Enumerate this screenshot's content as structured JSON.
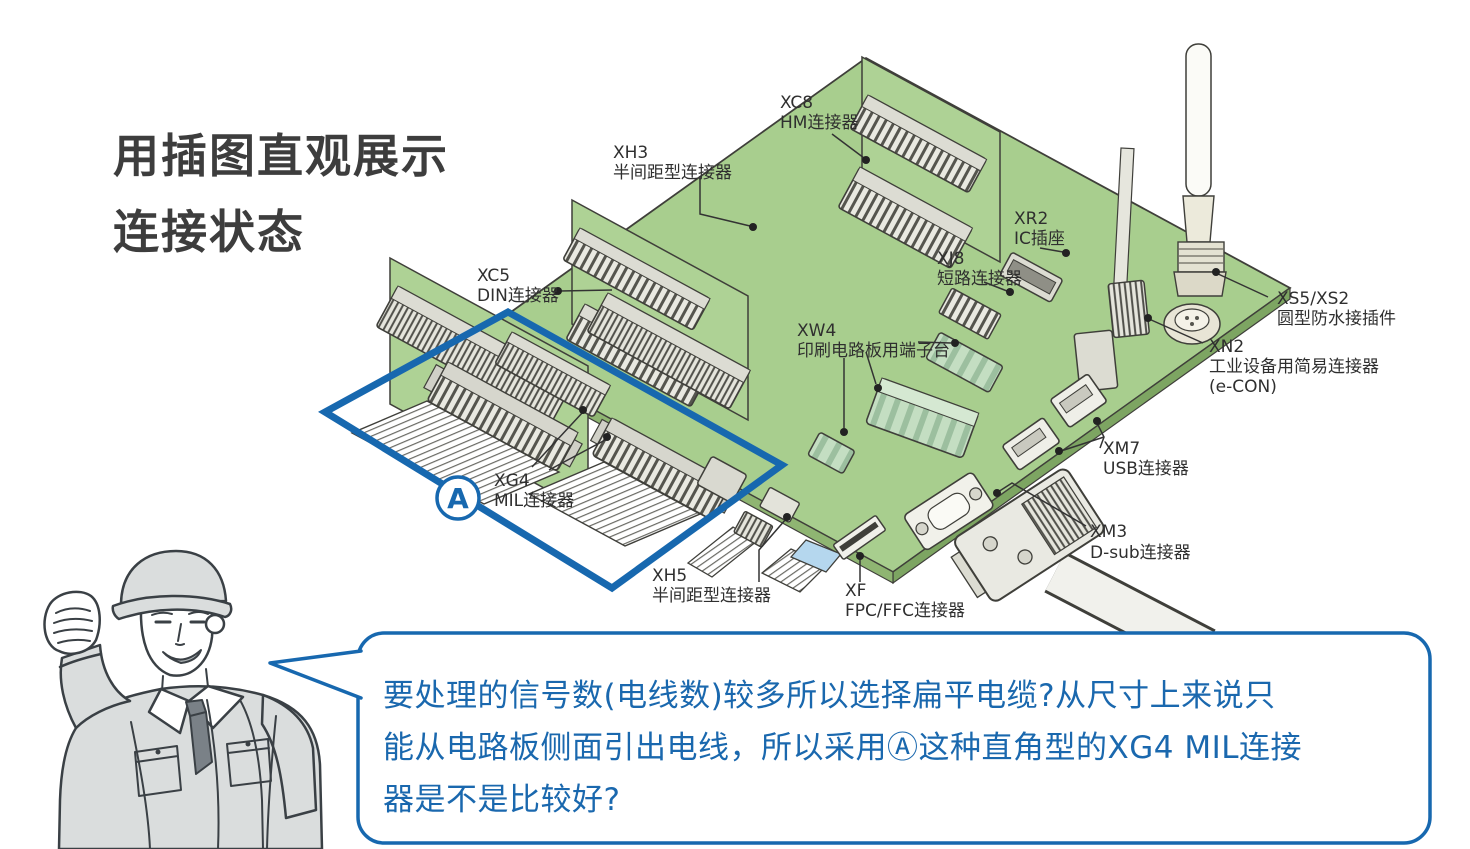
{
  "title": {
    "line1": "用插图直观展示",
    "line2": "连接状态"
  },
  "region_a": {
    "label": "A"
  },
  "labels": [
    {
      "code": "XC8",
      "name": "HM连接器"
    },
    {
      "code": "XH3",
      "name": "半间距型连接器"
    },
    {
      "code": "XC5",
      "name": "DIN连接器"
    },
    {
      "code": "XR2",
      "name": "IC插座"
    },
    {
      "code": "XJ8",
      "name": "短路连接器"
    },
    {
      "code": "XW4",
      "name": "印刷电路板用端子台"
    },
    {
      "code": "XS5/XS2",
      "name": "圆型防水接插件"
    },
    {
      "code": "XN2",
      "name": "工业设备用简易连接器",
      "name2": "(e-CON)"
    },
    {
      "code": "XM7",
      "name": "USB连接器"
    },
    {
      "code": "XM3",
      "name": "D-sub连接器"
    },
    {
      "code": "XG4",
      "name": "MIL连接器"
    },
    {
      "code": "XH5",
      "name": "半间距型连接器"
    },
    {
      "code": "XF",
      "name": "FPC/FFC连接器"
    }
  ],
  "speech_bubble": {
    "line1": "要处理的信号数(电线数)较多所以选择扁平电缆?从尺寸上来说只",
    "line2": "能从电路板侧面引出电线，所以采用Ⓐ这种直角型的XG4 MIL连接",
    "line3": "器是不是比较好?"
  },
  "colors": {
    "board_green": "#a8ce8e",
    "board_edge_dark": "#7da562",
    "board_edge_light": "#8fb572",
    "accent_blue": "#1768af",
    "outline": "#3f3f3a",
    "terminal_teal": "#c4dec2",
    "cable_blue": "#b5d7ee",
    "uniform_gray": "#dadddd"
  }
}
